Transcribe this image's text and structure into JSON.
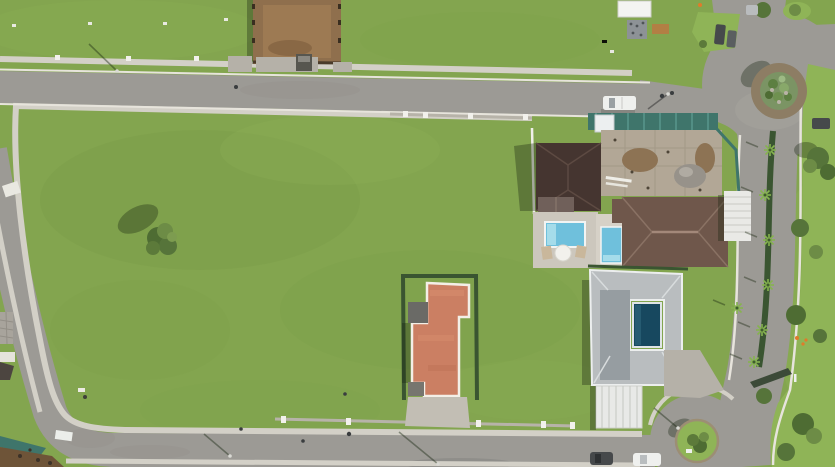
{
  "scene": {
    "type": "aerial-drone-photo",
    "description": "Top-down aerial photograph of a residential development block: a large empty green field ringed by an interior sidewalk loop and gray asphalt streets, a cluster of houses with swimming pools on the east side, a red-tile-roofed house at bottom center, a landscaped boulevard with palm median on the right, a planted traffic roundabout at top right and a cul-de-sac island at bottom right, plus small construction sites.",
    "time_of_day": "daytime, sunny, shadows cast toward upper-left",
    "counts": {
      "houses": 4,
      "pools": 3,
      "roundabouts": 2,
      "vehicles": 6,
      "construction_sites": 3
    }
  },
  "palette": {
    "grass": "#83a54f",
    "grass-light": "#8fb457",
    "grass-dark": "#6e9242",
    "road": "#9c9a95",
    "road-light": "#a8a6a0",
    "sidewalk": "#d3d0c7",
    "curb": "#e7e4dc",
    "wall": "#b7b3a9",
    "pillar": "#f2f1ec",
    "roof-dark": "#453530",
    "roof-brown": "#6f574b",
    "roof-gray": "#b9bdbf",
    "roof-gray-dark": "#969da1",
    "roof-red": "#cb7f63",
    "trim-white": "#f3efe7",
    "pool-cyan": "#6fc0dc",
    "pool-cyan-light": "#a5dcea",
    "pool-dark": "#17485f",
    "patio": "#ccc7bd",
    "deck": "#d6d1c7",
    "hedge": "#3a5531",
    "palm": "#86b34f",
    "teal-fence": "#3f756b",
    "dirt": "#8f6f4d",
    "dirt-dark": "#6e5438",
    "slab": "#b2a796",
    "rubble": "#97928a",
    "ring-dirt": "#8d7d64",
    "planter": "#7b9464",
    "tree": "#56743a",
    "tree-light": "#6d8c46",
    "concrete": "#b5b1a8",
    "car-dark": "#46494b",
    "car-white": "#eff0ee",
    "orange": "#e07b2a",
    "shadow": "rgba(25,38,16,0.35)"
  },
  "objects": [
    {
      "name": "empty-field",
      "description": "large vacant mowed grass field occupying the center of the block, one lone tree"
    },
    {
      "name": "sidewalk-loop",
      "description": "light concrete sidewalk ring around the interior of the block"
    },
    {
      "name": "top-street",
      "description": "east-west asphalt street across the upper part of the image"
    },
    {
      "name": "left-street",
      "description": "diagonal street down the left side, curving into the bottom street"
    },
    {
      "name": "bottom-street",
      "description": "east-west street along the bottom leading to a cul-de-sac"
    },
    {
      "name": "boulevard",
      "description": "divided road on the right with dark hedge median and small palm trees"
    },
    {
      "name": "roundabout",
      "description": "circular intersection top right with dirt ring and planted center island"
    },
    {
      "name": "cul-de-sac-island",
      "description": "round green island with a tree at the bottom-right street end"
    },
    {
      "name": "house-dark-roof",
      "description": "house with dark charcoal roof, rear patio, cyan pool, loungers and umbrella"
    },
    {
      "name": "house-brown-roof",
      "description": "large hip-roofed brown house with small cyan pool and white pergola carport"
    },
    {
      "name": "house-gray-roof",
      "description": "light gray courtyard house with central dark-blue pool, carport and driveway to cul-de-sac"
    },
    {
      "name": "house-red-roof",
      "description": "terracotta flat-tile roof house with white trim, hedged lot and concrete driveway"
    },
    {
      "name": "construction-dirt-lot",
      "description": "fenced brown dirt lot at top center"
    },
    {
      "name": "construction-foundation",
      "description": "concrete foundation slab with dirt and rubble behind teal mesh fencing"
    },
    {
      "name": "construction-corner",
      "description": "teal-fenced dirt corner at bottom left"
    },
    {
      "name": "white-pickup",
      "description": "white pickup truck parked on the top street"
    },
    {
      "name": "parked-cars-bottom",
      "description": "one dark and one white car parked near the cul-de-sac"
    },
    {
      "name": "parked-cars-top-right",
      "description": "two vehicles near the roundabout north exit"
    },
    {
      "name": "white-tent",
      "description": "white canopy tent and stacked materials on the grass at top right"
    },
    {
      "name": "street-lights",
      "description": "street lamps casting long shadows"
    },
    {
      "name": "east-lawn",
      "description": "bright lawn with trees and orange flowering shrubs along the right edge"
    },
    {
      "name": "field-tree",
      "description": "single bushy tree in the field with shadow to the upper left"
    }
  ]
}
